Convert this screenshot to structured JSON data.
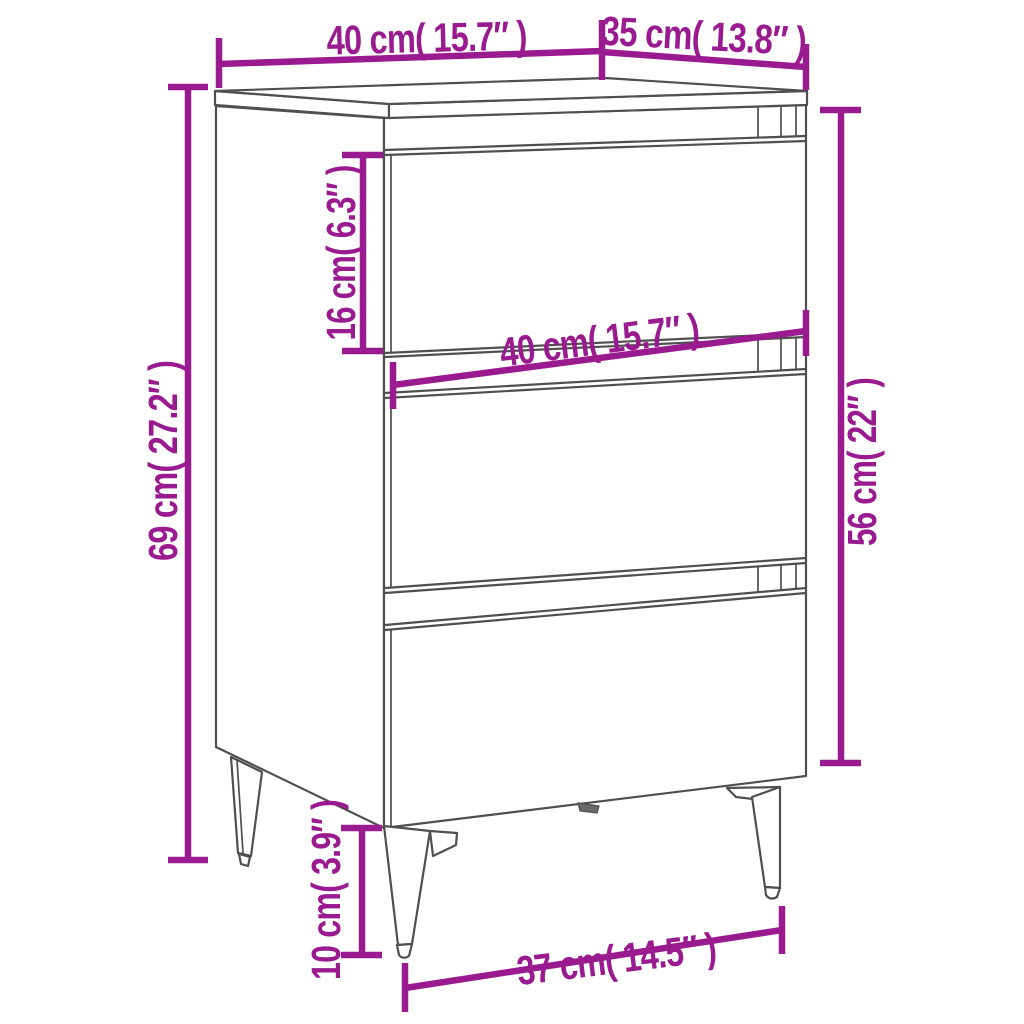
{
  "diagram": {
    "product": "bedside-cabinet-with-three-drawers-and-metal-legs",
    "dimensions": {
      "top_width": "40 cm( 15.7″ )",
      "top_depth": "35 cm( 13.8″ )",
      "overall_height": "69 cm( 27.2″ )",
      "drawer_height": "16 cm( 6.3″ )",
      "front_width": "40 cm( 15.7″ )",
      "body_height": "56 cm( 22″ )",
      "leg_height": "10 cm( 3.9″ )",
      "base_width": "37 cm( 14.5″ )"
    },
    "colors": {
      "dimension": "#9A1B8F",
      "outline": "#4F4F4F",
      "background": "#FFFFFF"
    }
  }
}
